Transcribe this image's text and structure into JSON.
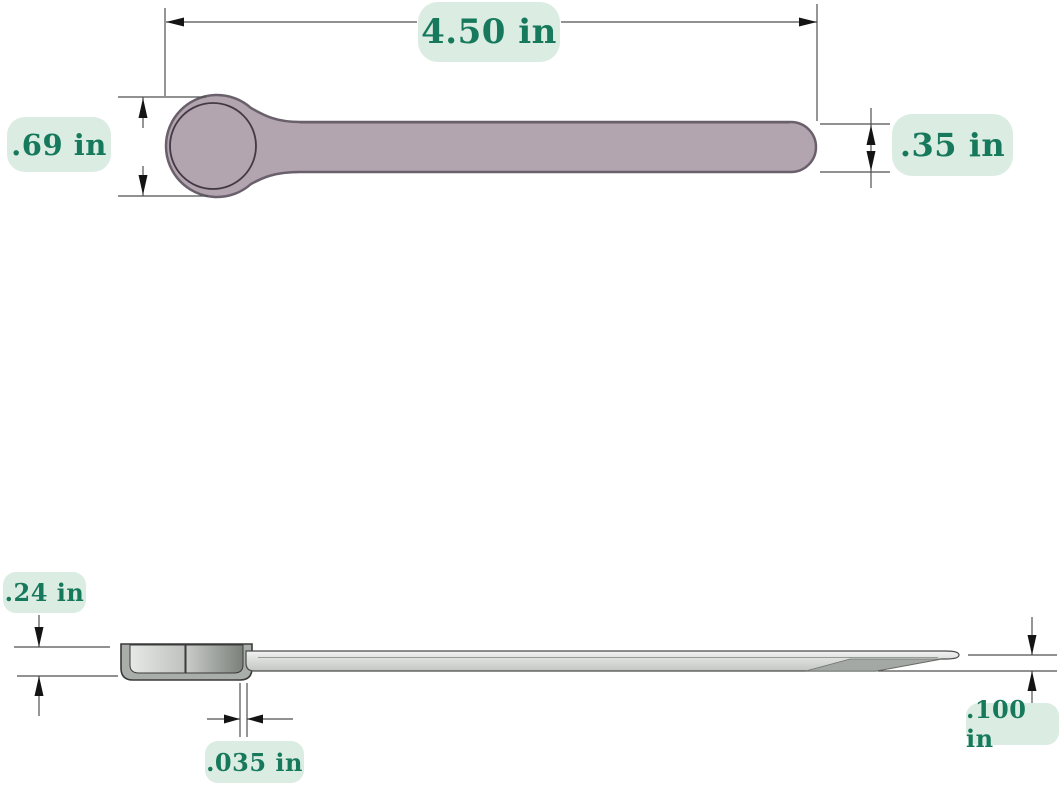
{
  "diagram": {
    "dimensions": {
      "overall_length": "4.50 in",
      "bowl_diameter": ".69 in",
      "handle_width": ".35 in",
      "bowl_depth": ".24 in",
      "wall_thickness": ".035 in",
      "tip_thickness": ".100 in"
    },
    "colors": {
      "background": "#ffffff",
      "label_background": "#dbece3",
      "label_text": "#17795c",
      "top_view_fill": "#b3a5af",
      "top_view_stroke": "#69606b",
      "side_view_fill_light": "#eef0ee",
      "side_view_fill_dark": "#7b807b",
      "dimension_line": "#4f4f4f",
      "arrowhead": "#141414"
    }
  }
}
